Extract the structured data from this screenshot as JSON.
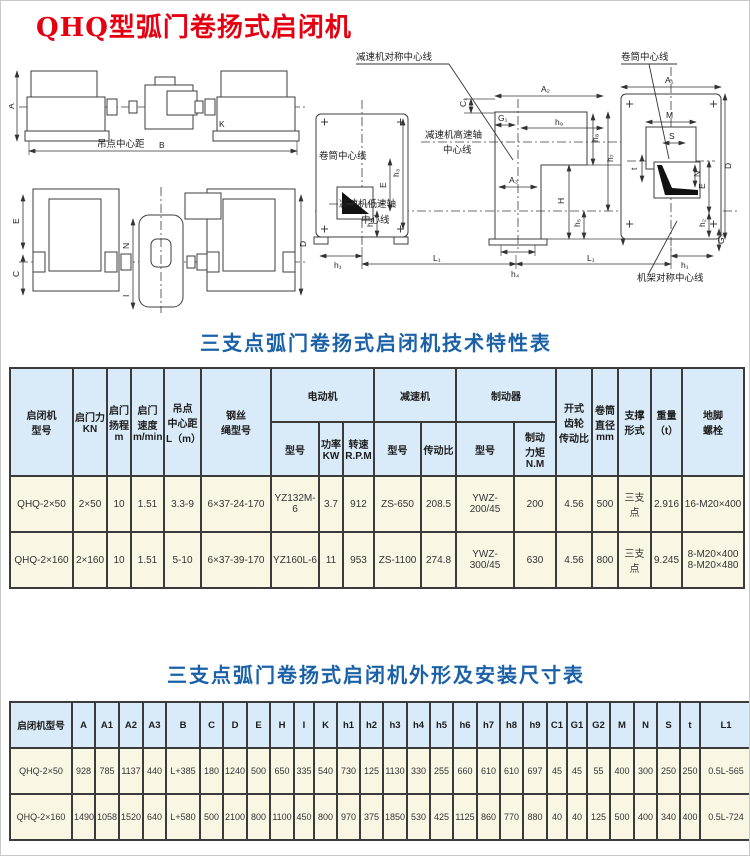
{
  "page": {
    "title": "QHQ型弧门卷扬式启闭机"
  },
  "diagram": {
    "left_front": {
      "dim_a": "A",
      "dim_b": "B",
      "dim_k": "K",
      "hoist_center_label": "吊点中心距"
    },
    "left_plan": {
      "dim_e": "E",
      "dim_c": "C",
      "dim_n": "N",
      "dim_i": "I",
      "dim_d": "D"
    },
    "right": {
      "callout_reducer_symmetry": "减速机对称中心线",
      "callout_drum_center_top": "卷筒中心线",
      "callout_drum_center_left": "卷筒中心线",
      "callout_high_speed_line1": "减速机高速轴",
      "callout_high_speed_line2": "中心线",
      "callout_low_speed_line1": "减速机低速轴",
      "callout_low_speed_line2": "中心线",
      "callout_frame_symmetry": "机架对称中心线",
      "dim_a1": "A₁",
      "dim_a2": "A₂",
      "dim_a3": "A₃",
      "dim_c1": "C₁",
      "dim_g1": "G₁",
      "dim_g2": "G₂",
      "dim_h": "H",
      "dim_e_left": "E",
      "dim_e_right": "E",
      "dim_d": "D",
      "dim_m": "M",
      "dim_s": "S",
      "dim_n": "N",
      "dim_t": "t",
      "dim_h1_left": "h₁",
      "dim_h1_right": "h₁",
      "dim_h2_left": "h₂",
      "dim_h2_right": "h₂",
      "dim_h3": "h₃",
      "dim_h4": "h₄",
      "dim_h5": "h₅",
      "dim_h6": "h₆",
      "dim_h7": "h₇",
      "dim_h8": "h₈",
      "dim_h9": "h₉",
      "dim_l1_left": "L₁",
      "dim_l1_right": "L₁"
    }
  },
  "table1": {
    "title": "三支点弧门卷扬式启闭机技术特性表",
    "headers": {
      "model": "启闭机\n型号",
      "force": "启门力\nKN",
      "lift": "启门\n扬程\nm",
      "speed": "启门\n速度\nm/min",
      "center_dist": "吊点\n中心距\nL（m）",
      "rope": "钢丝\n绳型号",
      "motor_group": "电动机",
      "reducer_group": "减速机",
      "brake_group": "制动器",
      "open_gear": "开式\n齿轮\n传动比",
      "drum_dia": "卷筒\n直径\nmm",
      "support": "支撑\n形式",
      "weight": "重量\n（t）",
      "anchor": "地脚\n螺栓",
      "motor_model": "型号",
      "motor_power": "功率\nKW",
      "motor_speed": "转速\nR.P.M",
      "reducer_model": "型号",
      "reducer_ratio": "传动比",
      "brake_model": "型号",
      "brake_torque": "制动\n力矩N.M"
    },
    "rows": [
      [
        "QHQ-2×50",
        "2×50",
        "10",
        "1.51",
        "3.3-9",
        "6×37-24-170",
        "YZ132M-6",
        "3.7",
        "912",
        "ZS-650",
        "208.5",
        "YWZ-200/45",
        "200",
        "4.56",
        "500",
        "三支点",
        "2.916",
        "16-M20×400"
      ],
      [
        "QHQ-2×160",
        "2×160",
        "10",
        "1.51",
        "5-10",
        "6×37-39-170",
        "YZ160L-6",
        "11",
        "953",
        "ZS-1100",
        "274.8",
        "YWZ-300/45",
        "630",
        "4.56",
        "800",
        "三支点",
        "9.245",
        "8-M20×400\n8-M20×480"
      ]
    ]
  },
  "table2": {
    "title": "三支点弧门卷扬式启闭机外形及安装尺寸表",
    "headers": [
      "启闭机型号",
      "A",
      "A1",
      "A2",
      "A3",
      "B",
      "C",
      "D",
      "E",
      "H",
      "I",
      "K",
      "h1",
      "h2",
      "h3",
      "h4",
      "h5",
      "h6",
      "h7",
      "h8",
      "h9",
      "C1",
      "G1",
      "G2",
      "M",
      "N",
      "S",
      "t",
      "L1"
    ],
    "rows": [
      [
        "QHQ-2×50",
        "928",
        "785",
        "1137",
        "440",
        "L+385",
        "180",
        "1240",
        "500",
        "650",
        "335",
        "540",
        "730",
        "125",
        "1130",
        "330",
        "255",
        "660",
        "610",
        "610",
        "697",
        "45",
        "45",
        "55",
        "400",
        "300",
        "250",
        "250",
        "0.5L-565"
      ],
      [
        "QHQ-2×160",
        "1490",
        "1058",
        "1520",
        "640",
        "L+580",
        "500",
        "2100",
        "800",
        "1100",
        "450",
        "800",
        "970",
        "375",
        "1850",
        "530",
        "425",
        "1125",
        "860",
        "770",
        "880",
        "40",
        "40",
        "125",
        "500",
        "400",
        "340",
        "400",
        "0.5L-724"
      ]
    ]
  }
}
